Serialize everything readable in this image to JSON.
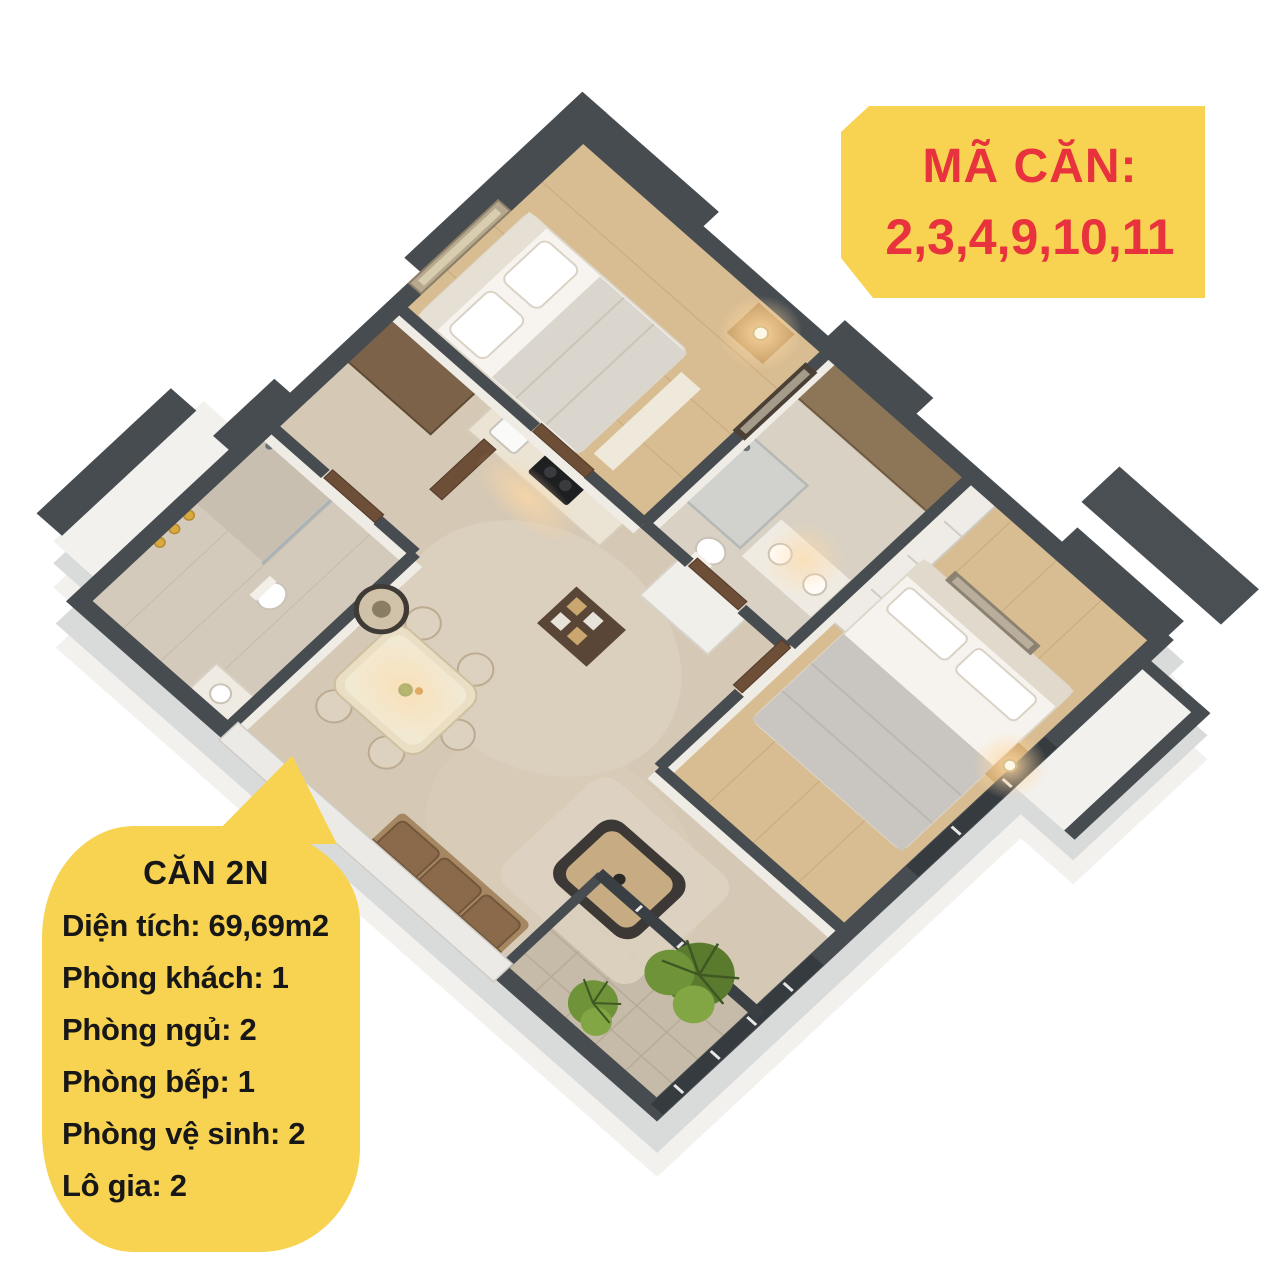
{
  "unit_code": {
    "label": "MÃ CĂN:",
    "value": "2,3,4,9,10,11",
    "bg_color": "#F7D351",
    "text_color": "#E8323E"
  },
  "unit_info": {
    "title": "CĂN 2N",
    "bg_color": "#F7D351",
    "text_color": "#171717",
    "lines": [
      "Diện tích: 69,69m2",
      "Phòng khách: 1",
      "Phòng ngủ: 2",
      "Phòng bếp: 1",
      "Phòng vệ sinh: 2",
      "Lô gia: 2"
    ]
  },
  "palette": {
    "background": "#FFFFFF",
    "wall_dark": "#474C51",
    "floor_base": "#D5C8B5",
    "floor_wood": "#D9BD92",
    "floor_tile": "#D3CABB",
    "balcony_tile": "#C6BBA8",
    "fascia_white": "#F2F1EE",
    "fascia_gray": "#D9DADA",
    "door_walnut": "#6D4F37",
    "plant_green": "#5A7A2E",
    "warm_light": "#FFD9A3"
  }
}
